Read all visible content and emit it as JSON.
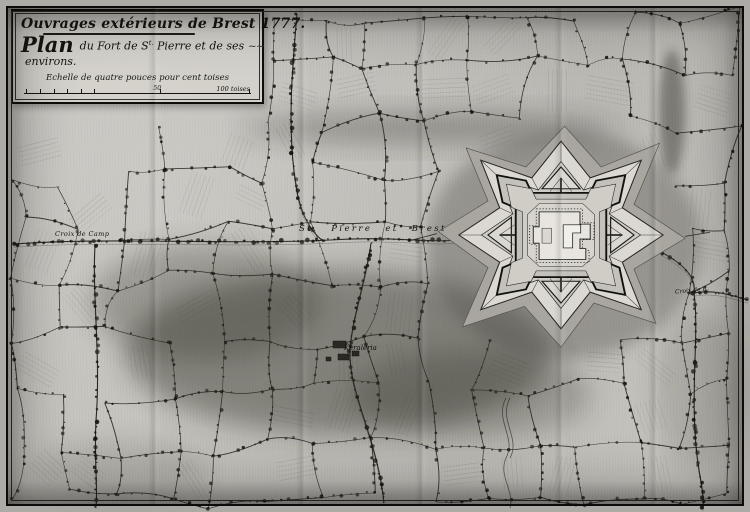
{
  "cartouche": {
    "line1": "Ouvrages extérieurs de Brest 1777.",
    "plan_word": "Plan",
    "line2_a": "du Fort de S",
    "line2_sup": "t.",
    "line2_b": " Pierre et de ses",
    "flourish": "~~",
    "line3": "environs.",
    "scale_caption": "Echelle de quatre pouces pour cent toises",
    "scale_mid_label": "50",
    "scale_right_label": "100 toises"
  },
  "labels": {
    "croix_de_camp": "Croix de Camp",
    "road_st_pierre_brest": "St. Pierre et Brest",
    "keraleria": "Keraleria",
    "croix_de_r": "Croix de R."
  },
  "colors": {
    "paper": "#c6c4be",
    "ink": "#15140f",
    "terrain_shading": "#26251f",
    "fort_glacis": "#dad8d1"
  }
}
